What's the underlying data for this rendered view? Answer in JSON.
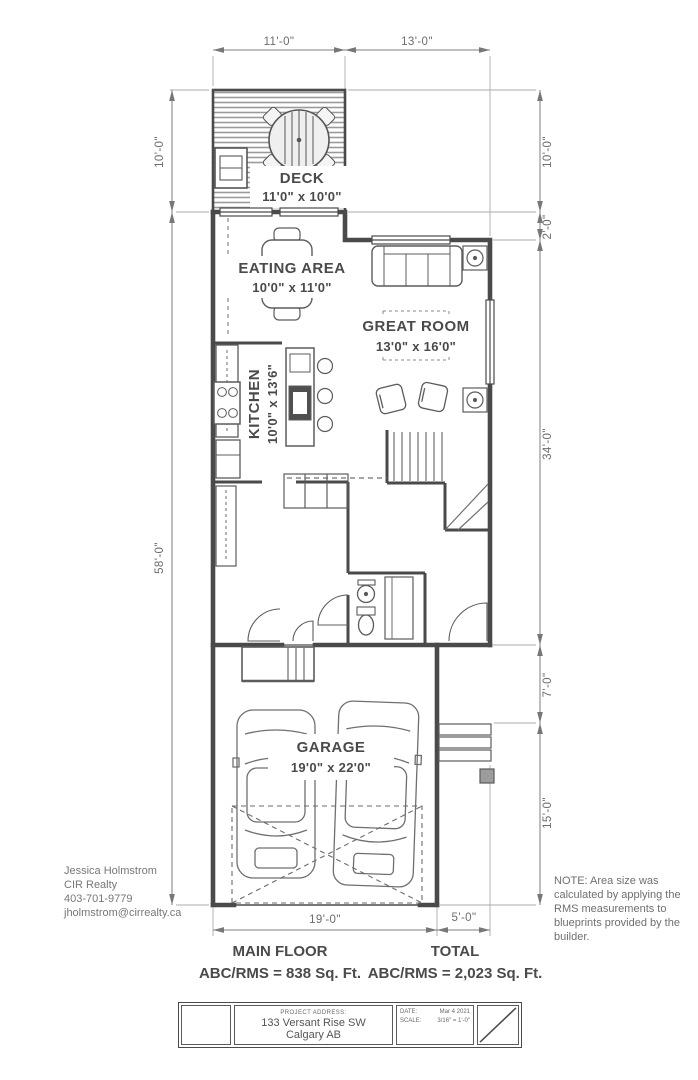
{
  "colors": {
    "wall": "#4a4a4a",
    "thin_line": "#707070",
    "dim_line": "#8a8a8a",
    "text_dark": "#4a4a4a",
    "text_gray": "#6f6f6f",
    "hatch": "#9a9a9a",
    "pad_fill": "#9c9c9c"
  },
  "rooms": [
    {
      "name": "DECK",
      "size": "11'0\" x 10'0\""
    },
    {
      "name": "EATING AREA",
      "size": "10'0\" x 11'0\""
    },
    {
      "name": "GREAT ROOM",
      "size": "13'0\" x 16'0\""
    },
    {
      "name": "KITCHEN",
      "size": "10'0\" x 13'6\""
    },
    {
      "name": "GARAGE",
      "size": "19'0\" x 22'0\""
    }
  ],
  "dims": {
    "top": [
      "11'-0\"",
      "13'-0\""
    ],
    "left": [
      "10'-0\"",
      "58'-0\""
    ],
    "right": [
      "10'-0\"",
      "2'-0\"",
      "34'-0\"",
      "7'-0\"",
      "15'-0\""
    ],
    "bottom": [
      "19'-0\"",
      "5'-0\""
    ]
  },
  "agent": {
    "name": "Jessica Holmstrom",
    "company": "CIR Realty",
    "phone": "403-701-9779",
    "email": "jholmstrom@cirrealty.ca"
  },
  "note": "NOTE: Area size was calculated by applying the RMS measurements to blueprints provided by the builder.",
  "areas": {
    "main_floor_label": "MAIN FLOOR",
    "main_floor_value": "ABC/RMS = 838 Sq. Ft.",
    "total_label": "TOTAL",
    "total_value": "ABC/RMS = 2,023 Sq. Ft."
  },
  "title_block": {
    "project_address_label": "PROJECT ADDRESS:",
    "address_line1": "133 Versant Rise SW",
    "address_line2": "Calgary AB",
    "date_label": "DATE:",
    "date_value": "Mar 4 2021",
    "scale_label": "SCALE:",
    "scale_value": "3/16\" = 1'-0\""
  }
}
